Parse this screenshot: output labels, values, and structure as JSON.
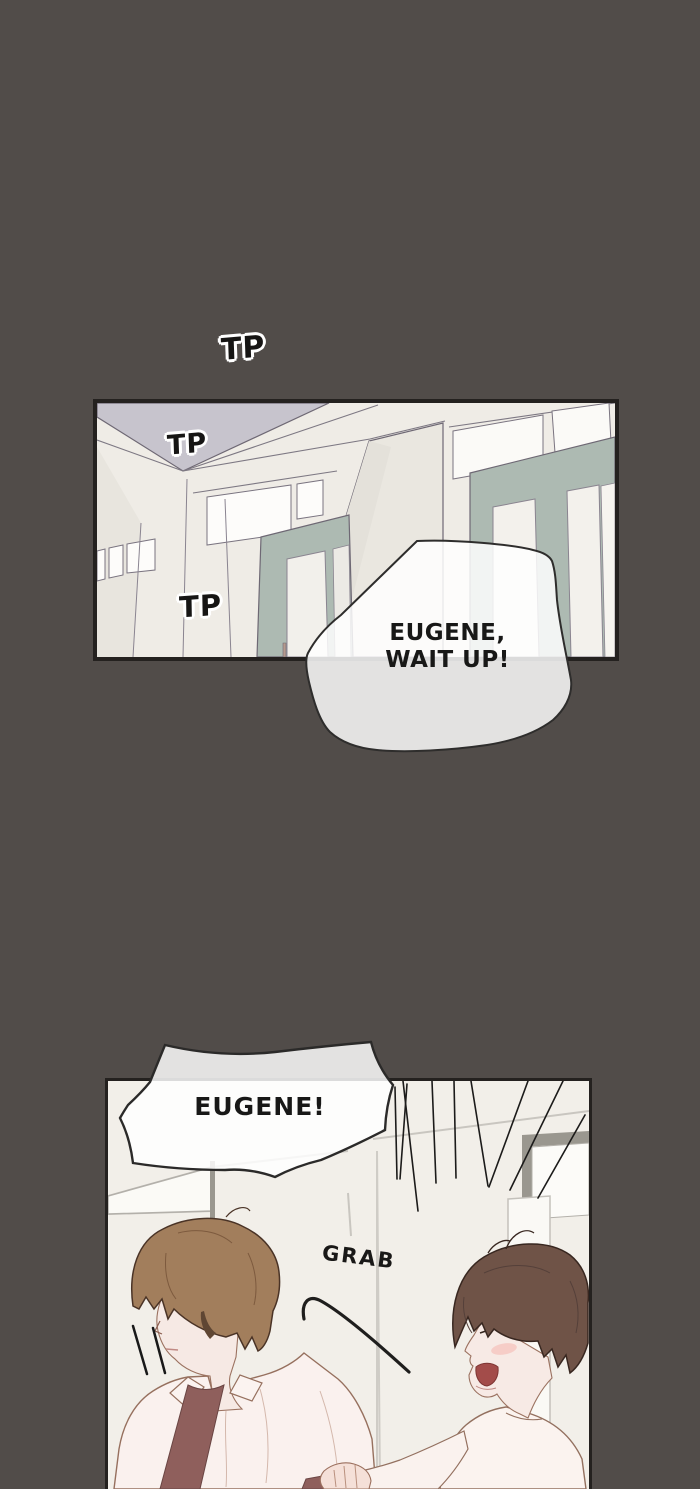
{
  "page": {
    "kind": "webtoon-comic-page",
    "width": 700,
    "height": 1489,
    "background": "#514c49"
  },
  "sound_effects": [
    {
      "id": "tp-top",
      "text": "TP"
    },
    {
      "id": "tp-ceiling",
      "text": "TP"
    },
    {
      "id": "tp-wall",
      "text": "TP"
    },
    {
      "id": "grab",
      "text": "GRAB"
    }
  ],
  "speech_bubbles": [
    {
      "id": "wait-up",
      "lines": [
        "EUGENE,",
        "WAIT UP!"
      ]
    },
    {
      "id": "eugene-shout",
      "lines": [
        "EUGENE!"
      ]
    }
  ],
  "panels": [
    {
      "id": "hallway-panel",
      "description": "empty hallway corner seen from below: gray ceiling, cream walls, transom windows, teal sliding doors"
    },
    {
      "id": "grab-scene-panel",
      "description": "brown-haired man with eyes hidden by bangs; second man in profile shouting and grabbing his arm; speed lines"
    }
  ],
  "colors": {
    "background": "#514c49",
    "panel_wall": "#f0ede7",
    "ceiling": "#c7c4cd",
    "door_teal": "#adbab2",
    "window_white": "#fbfaf7",
    "hair_left": "#a27e5c",
    "hair_right": "#6f5347",
    "skin": "#f6e9e4",
    "shirt": "#faf1ee",
    "tie_mauve": "#8f5f5c",
    "mouth_red": "#a34c4a",
    "ink": "#1c1b1a",
    "bubble_fill": "rgba(255,255,255,0.84)"
  }
}
